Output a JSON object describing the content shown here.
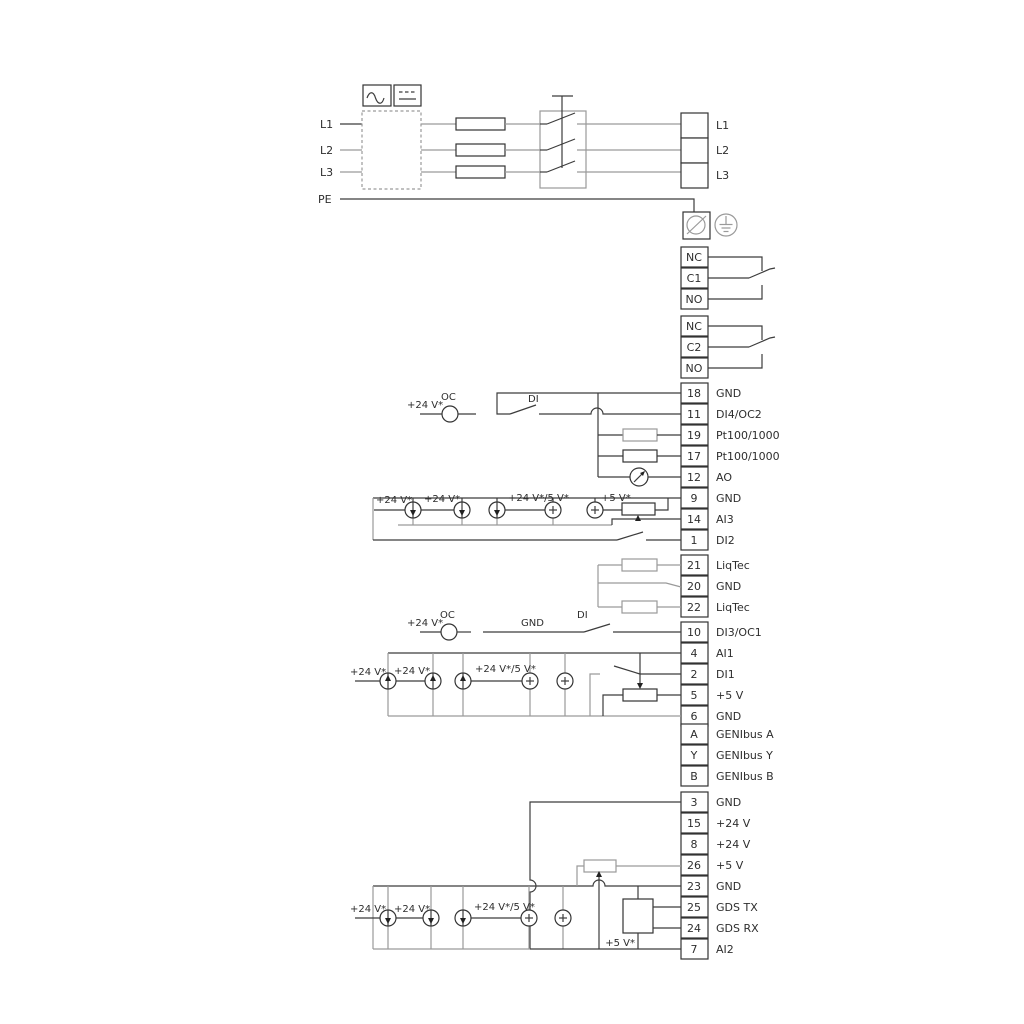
{
  "power": {
    "input_labels": [
      "L1",
      "L2",
      "L3",
      "PE"
    ],
    "output_labels": [
      "L1",
      "L2",
      "L3"
    ]
  },
  "relay1": {
    "terminals": [
      "NC",
      "C1",
      "NO"
    ]
  },
  "relay2": {
    "terminals": [
      "NC",
      "C2",
      "NO"
    ]
  },
  "io_block_a": [
    {
      "num": "18",
      "label": "GND"
    },
    {
      "num": "11",
      "label": "DI4/OC2"
    },
    {
      "num": "19",
      "label": "Pt100/1000"
    },
    {
      "num": "17",
      "label": "Pt100/1000"
    },
    {
      "num": "12",
      "label": "AO"
    },
    {
      "num": "9",
      "label": "GND"
    },
    {
      "num": "14",
      "label": "AI3"
    },
    {
      "num": "1",
      "label": "DI2"
    }
  ],
  "liqtec_block": [
    {
      "num": "21",
      "label": "LiqTec"
    },
    {
      "num": "20",
      "label": "GND"
    },
    {
      "num": "22",
      "label": "LiqTec"
    }
  ],
  "io_block_b": [
    {
      "num": "10",
      "label": "DI3/OC1"
    },
    {
      "num": "4",
      "label": "AI1"
    },
    {
      "num": "2",
      "label": "DI1"
    },
    {
      "num": "5",
      "label": "+5 V"
    },
    {
      "num": "6",
      "label": "GND"
    },
    {
      "num": "A",
      "label": "GENIbus A"
    },
    {
      "num": "Y",
      "label": "GENIbus Y"
    },
    {
      "num": "B",
      "label": "GENIbus B"
    }
  ],
  "io_block_c": [
    {
      "num": "3",
      "label": "GND"
    },
    {
      "num": "15",
      "label": "+24 V"
    },
    {
      "num": "8",
      "label": "+24 V"
    },
    {
      "num": "26",
      "label": "+5 V"
    },
    {
      "num": "23",
      "label": "GND"
    },
    {
      "num": "25",
      "label": "GDS TX"
    },
    {
      "num": "24",
      "label": "GDS RX"
    },
    {
      "num": "7",
      "label": "AI2"
    }
  ],
  "annotations": {
    "v24": "+24 V*",
    "v24_5": "+24 V*/5 V*",
    "v5": "+5 V*",
    "oc": "OC",
    "di": "DI",
    "gnd": "GND"
  },
  "colors": {
    "wire": "#3c3c3c",
    "gray": "#9a9a9a",
    "text": "#2e2e2e",
    "background": "#ffffff"
  }
}
